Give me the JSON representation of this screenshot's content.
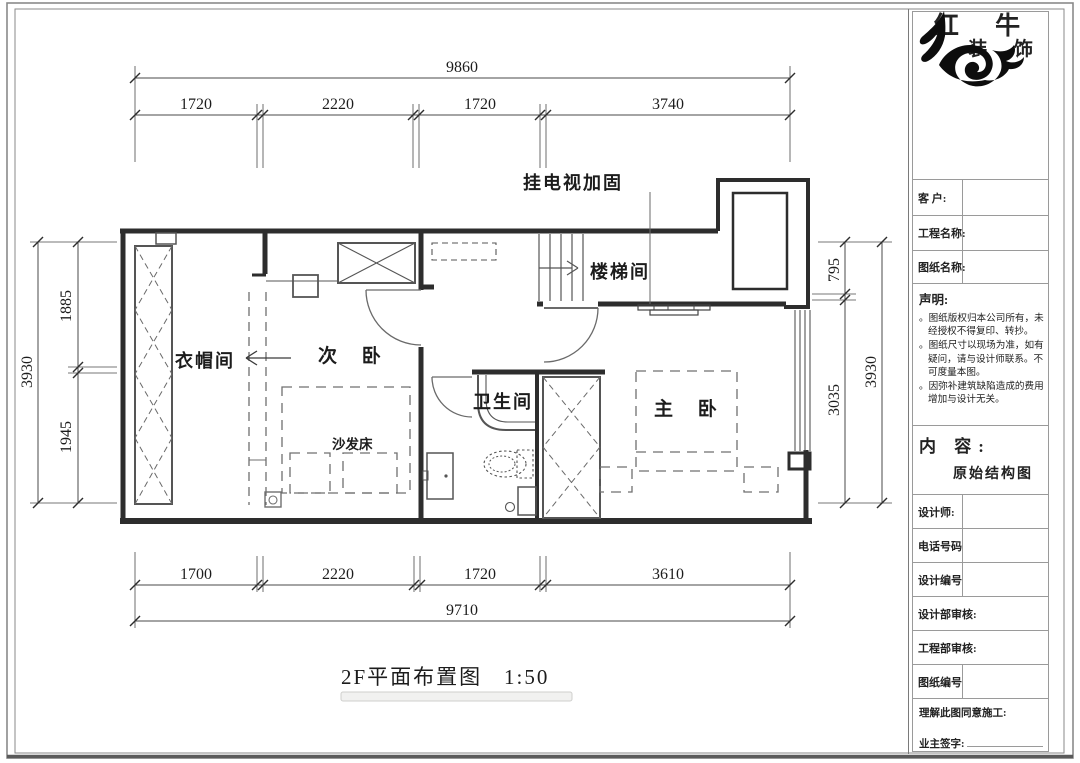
{
  "drawing": {
    "title": "2F平面布置图",
    "scale": "1:50",
    "annotation_tv": "挂电视加固",
    "rooms": {
      "cloakroom": "衣帽间",
      "second_bedroom": "次 卧",
      "bathroom": "卫生间",
      "master_bedroom": "主 卧",
      "stairwell": "楼梯间",
      "sofa_bed": "沙发床"
    },
    "dimensions": {
      "top": {
        "total": "9860",
        "seg1": "1720",
        "seg2": "2220",
        "seg3": "1720",
        "seg4": "3740"
      },
      "bottom": {
        "total": "9710",
        "seg1": "1700",
        "seg2": "2220",
        "seg3": "1720",
        "seg4": "3610"
      },
      "left": {
        "total": "3930",
        "seg1": "1885",
        "seg2": "1945"
      },
      "right": {
        "total": "3930",
        "seg1": "795",
        "seg2": "3035"
      }
    },
    "colors": {
      "wall": "#2d2d2d",
      "fixture": "#555555",
      "dashed": "#6f6f6f",
      "dimension": "#4a4a4a"
    }
  },
  "title_block": {
    "brand_name": "红 牛",
    "brand_suffix": "装 饰",
    "customer_label": "客  户:",
    "project_label": "工程名称:",
    "sheet_name_label": "图纸名称:",
    "statement_heading": "声明:",
    "statement_bullet": "。",
    "statement_lines": [
      "。图纸版权归本公司所有，未经授权不得复印、转抄。",
      "。图纸尺寸以现场为准，如有疑问，请与设计师联系。不可度量本图。",
      "。因弥补建筑缺陷造成的费用增加与设计无关。"
    ],
    "content_heading": "内 容:",
    "content_value": "原始结构图",
    "designer_label": "设计师:",
    "phone_label": "电话号码",
    "design_no_label": "设计编号",
    "design_dept_label": "设计部审核:",
    "eng_dept_label": "工程部审核:",
    "sheet_no_label": "图纸编号",
    "agree_label": "理解此图同意施工:",
    "owner_sign_label": "业主签字:"
  }
}
